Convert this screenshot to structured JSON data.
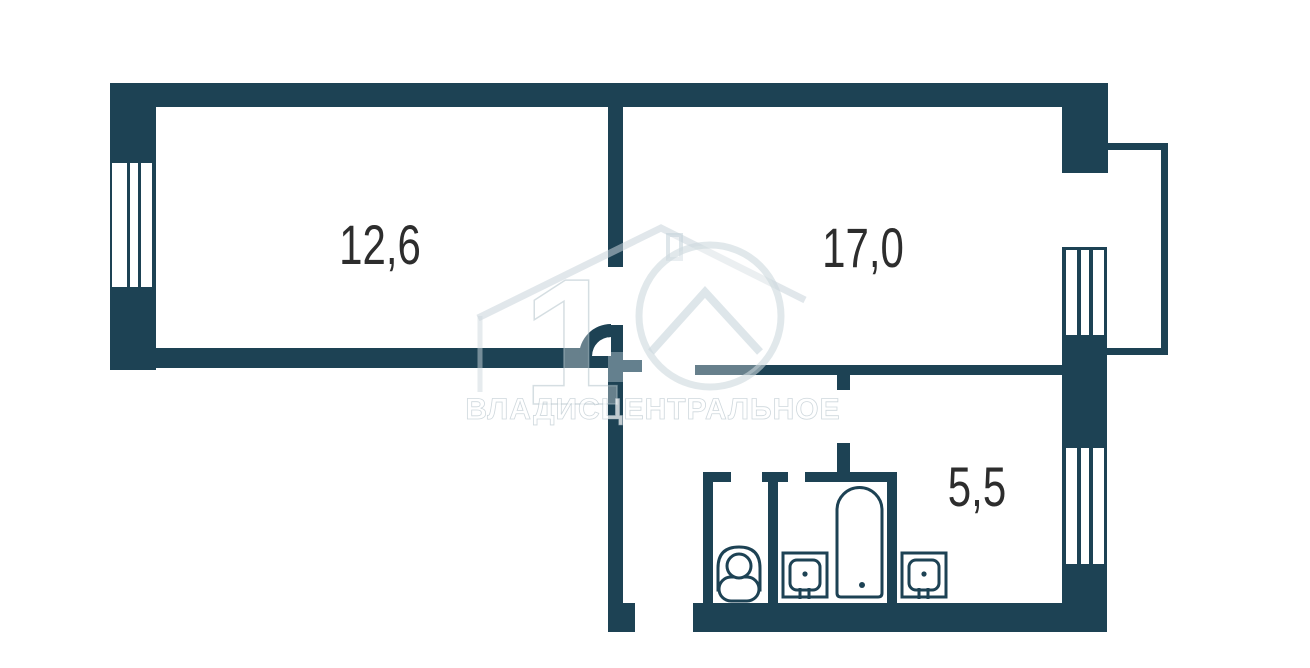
{
  "plan": {
    "rooms": [
      {
        "id": "living-room",
        "area_label": "12,6"
      },
      {
        "id": "bedroom",
        "area_label": "17,0"
      },
      {
        "id": "kitchen",
        "area_label": "5,5"
      }
    ],
    "watermark": {
      "number": "1",
      "text": "ВЛАДИСЦЕНТРАЛЬНОЕ"
    },
    "colors": {
      "wall": "#1d4254",
      "wall_faded": "#64808e",
      "fixture_outline": "#1d4254",
      "room_label": "#2d2d2d",
      "background": "#ffffff"
    },
    "symbols": {
      "windows": "window-hatch-icon",
      "balcony": "balcony-outline-icon",
      "door_swing": "door-arc-icon",
      "toilet": "toilet-icon",
      "bathtub": "bathtub-icon",
      "bathroom_sink": "sink-icon",
      "kitchen_sink": "sink-icon"
    }
  }
}
